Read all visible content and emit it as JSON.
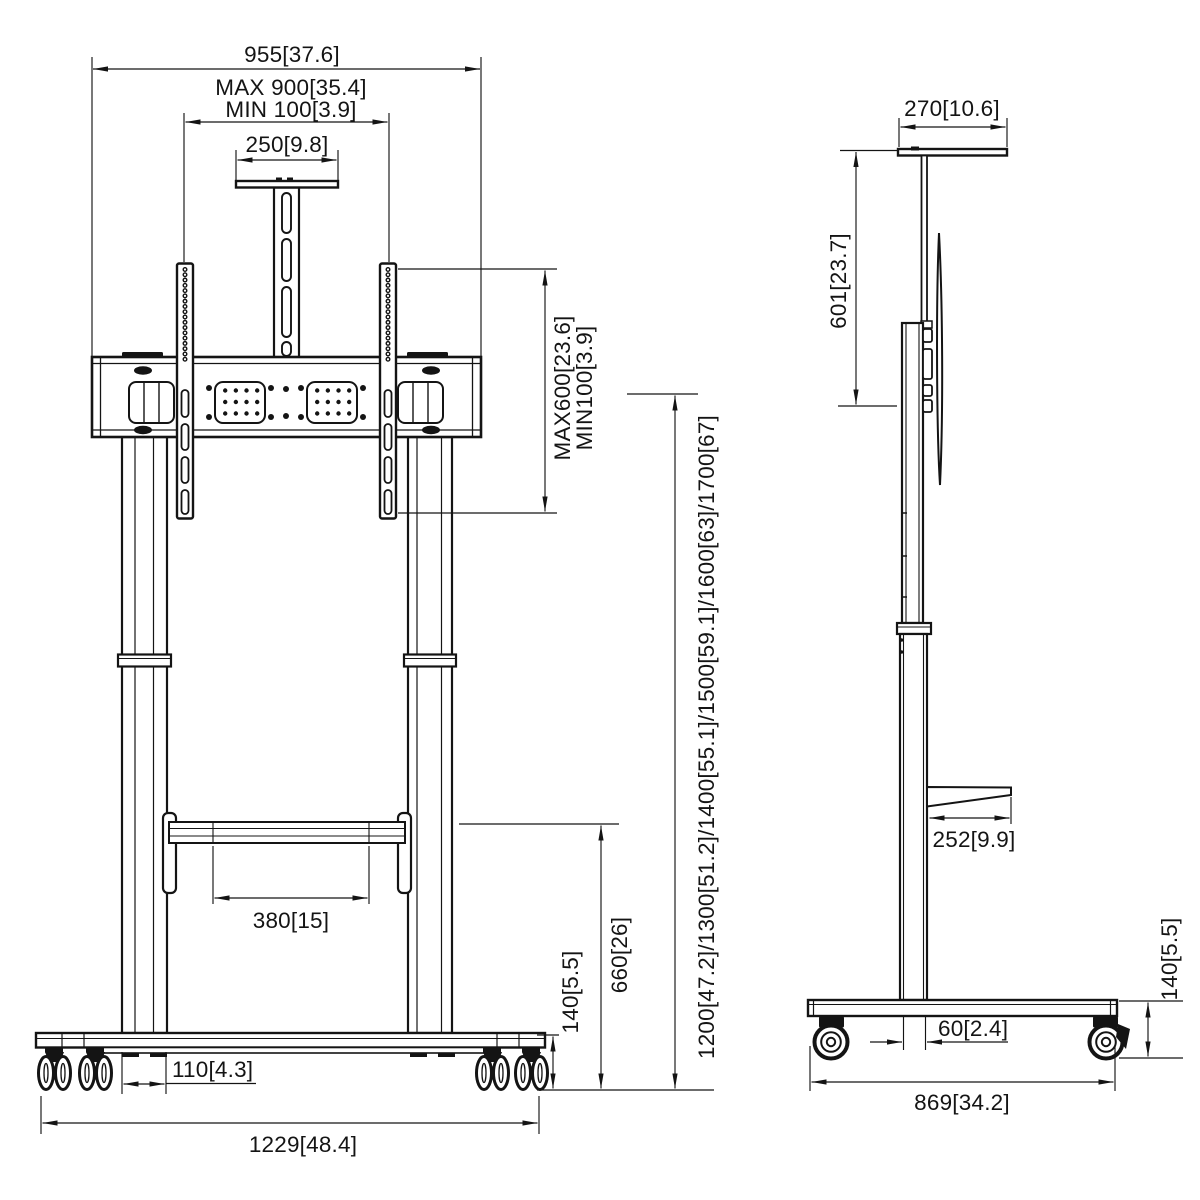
{
  "drawing": {
    "front_view": {
      "total_width": "955[37.6]",
      "vesa_width_max": "MAX 900[35.4]",
      "vesa_width_min": "MIN 100[3.9]",
      "camera_shelf_width": "250[9.8]",
      "vesa_height_max": "MAX600[23.6]",
      "vesa_height_min": "MIN100[3.9]",
      "height_options": "1200[47.2]/1300[51.2]/1400[55.1]/1500[59.1]/1600[63]/1700[67]",
      "shelf_width": "380[15]",
      "shelf_height": "660[26]",
      "caster_height": "140[5.5]",
      "leg_width_at_base": "110[4.3]",
      "base_width": "1229[48.4]"
    },
    "side_view": {
      "top_shelf_depth": "270[10.6]",
      "upper_column_height": "601[23.7]",
      "shelf_depth": "252[9.9]",
      "column_depth": "60[2.4]",
      "base_depth": "869[34.2]",
      "caster_height": "140[5.5]"
    },
    "colors": {
      "line": "#141414",
      "background": "#ffffff"
    }
  }
}
